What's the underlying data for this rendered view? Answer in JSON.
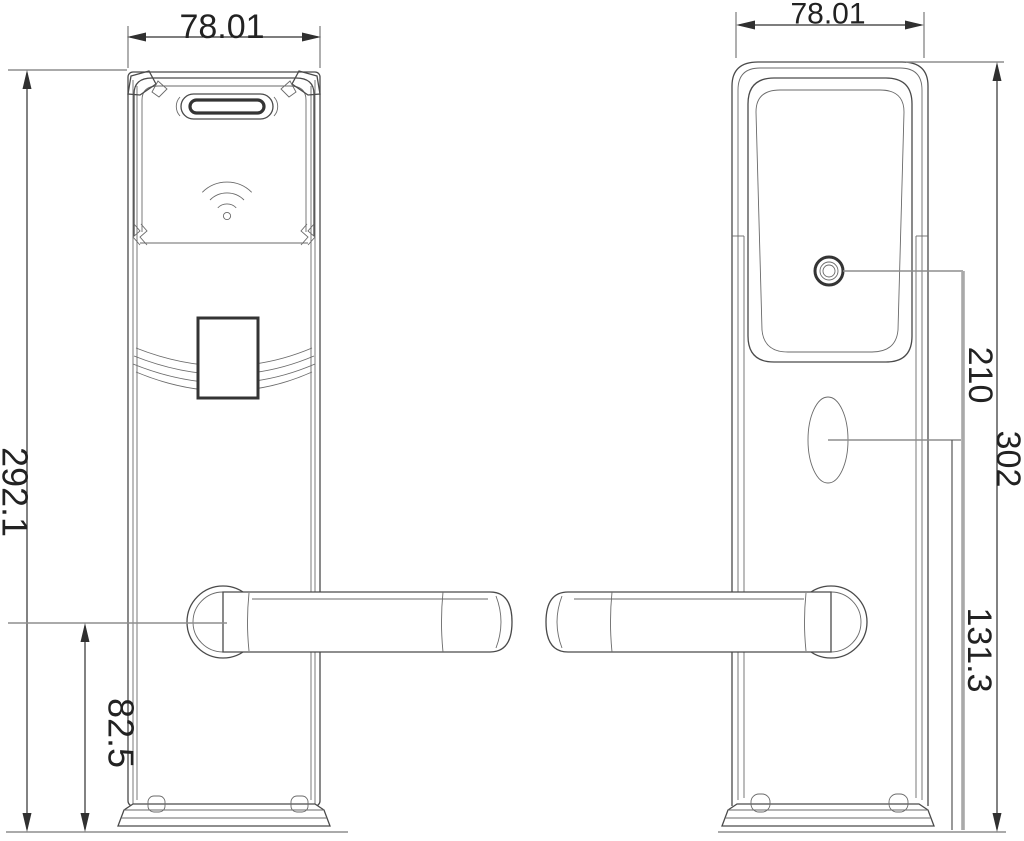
{
  "drawing": {
    "kind": "technical-dimension-drawing",
    "subject": "card-operated door lock, front panel and back panel elevation views",
    "units_shown": "none (numeric dimension values only)"
  },
  "dimensions": {
    "front_width": "78.01",
    "back_width": "78.01",
    "front_height": "292.1",
    "handle_to_bottom": "82.5",
    "cylinder_to_bottom": "210",
    "back_height": "302",
    "oval_to_bottom": "131.3"
  },
  "icons": {
    "front_reader": "rfid-signal-icon",
    "front_slot": "card-slot",
    "back_cylinder": "key-cylinder",
    "back_oval": "oval-cutout"
  },
  "colors": {
    "background": "#ffffff",
    "outline": "#4a4a4a",
    "dimension": "#303030",
    "extension": "#8d8d8d",
    "thick_gray_dimension": "#a9a9a9"
  }
}
